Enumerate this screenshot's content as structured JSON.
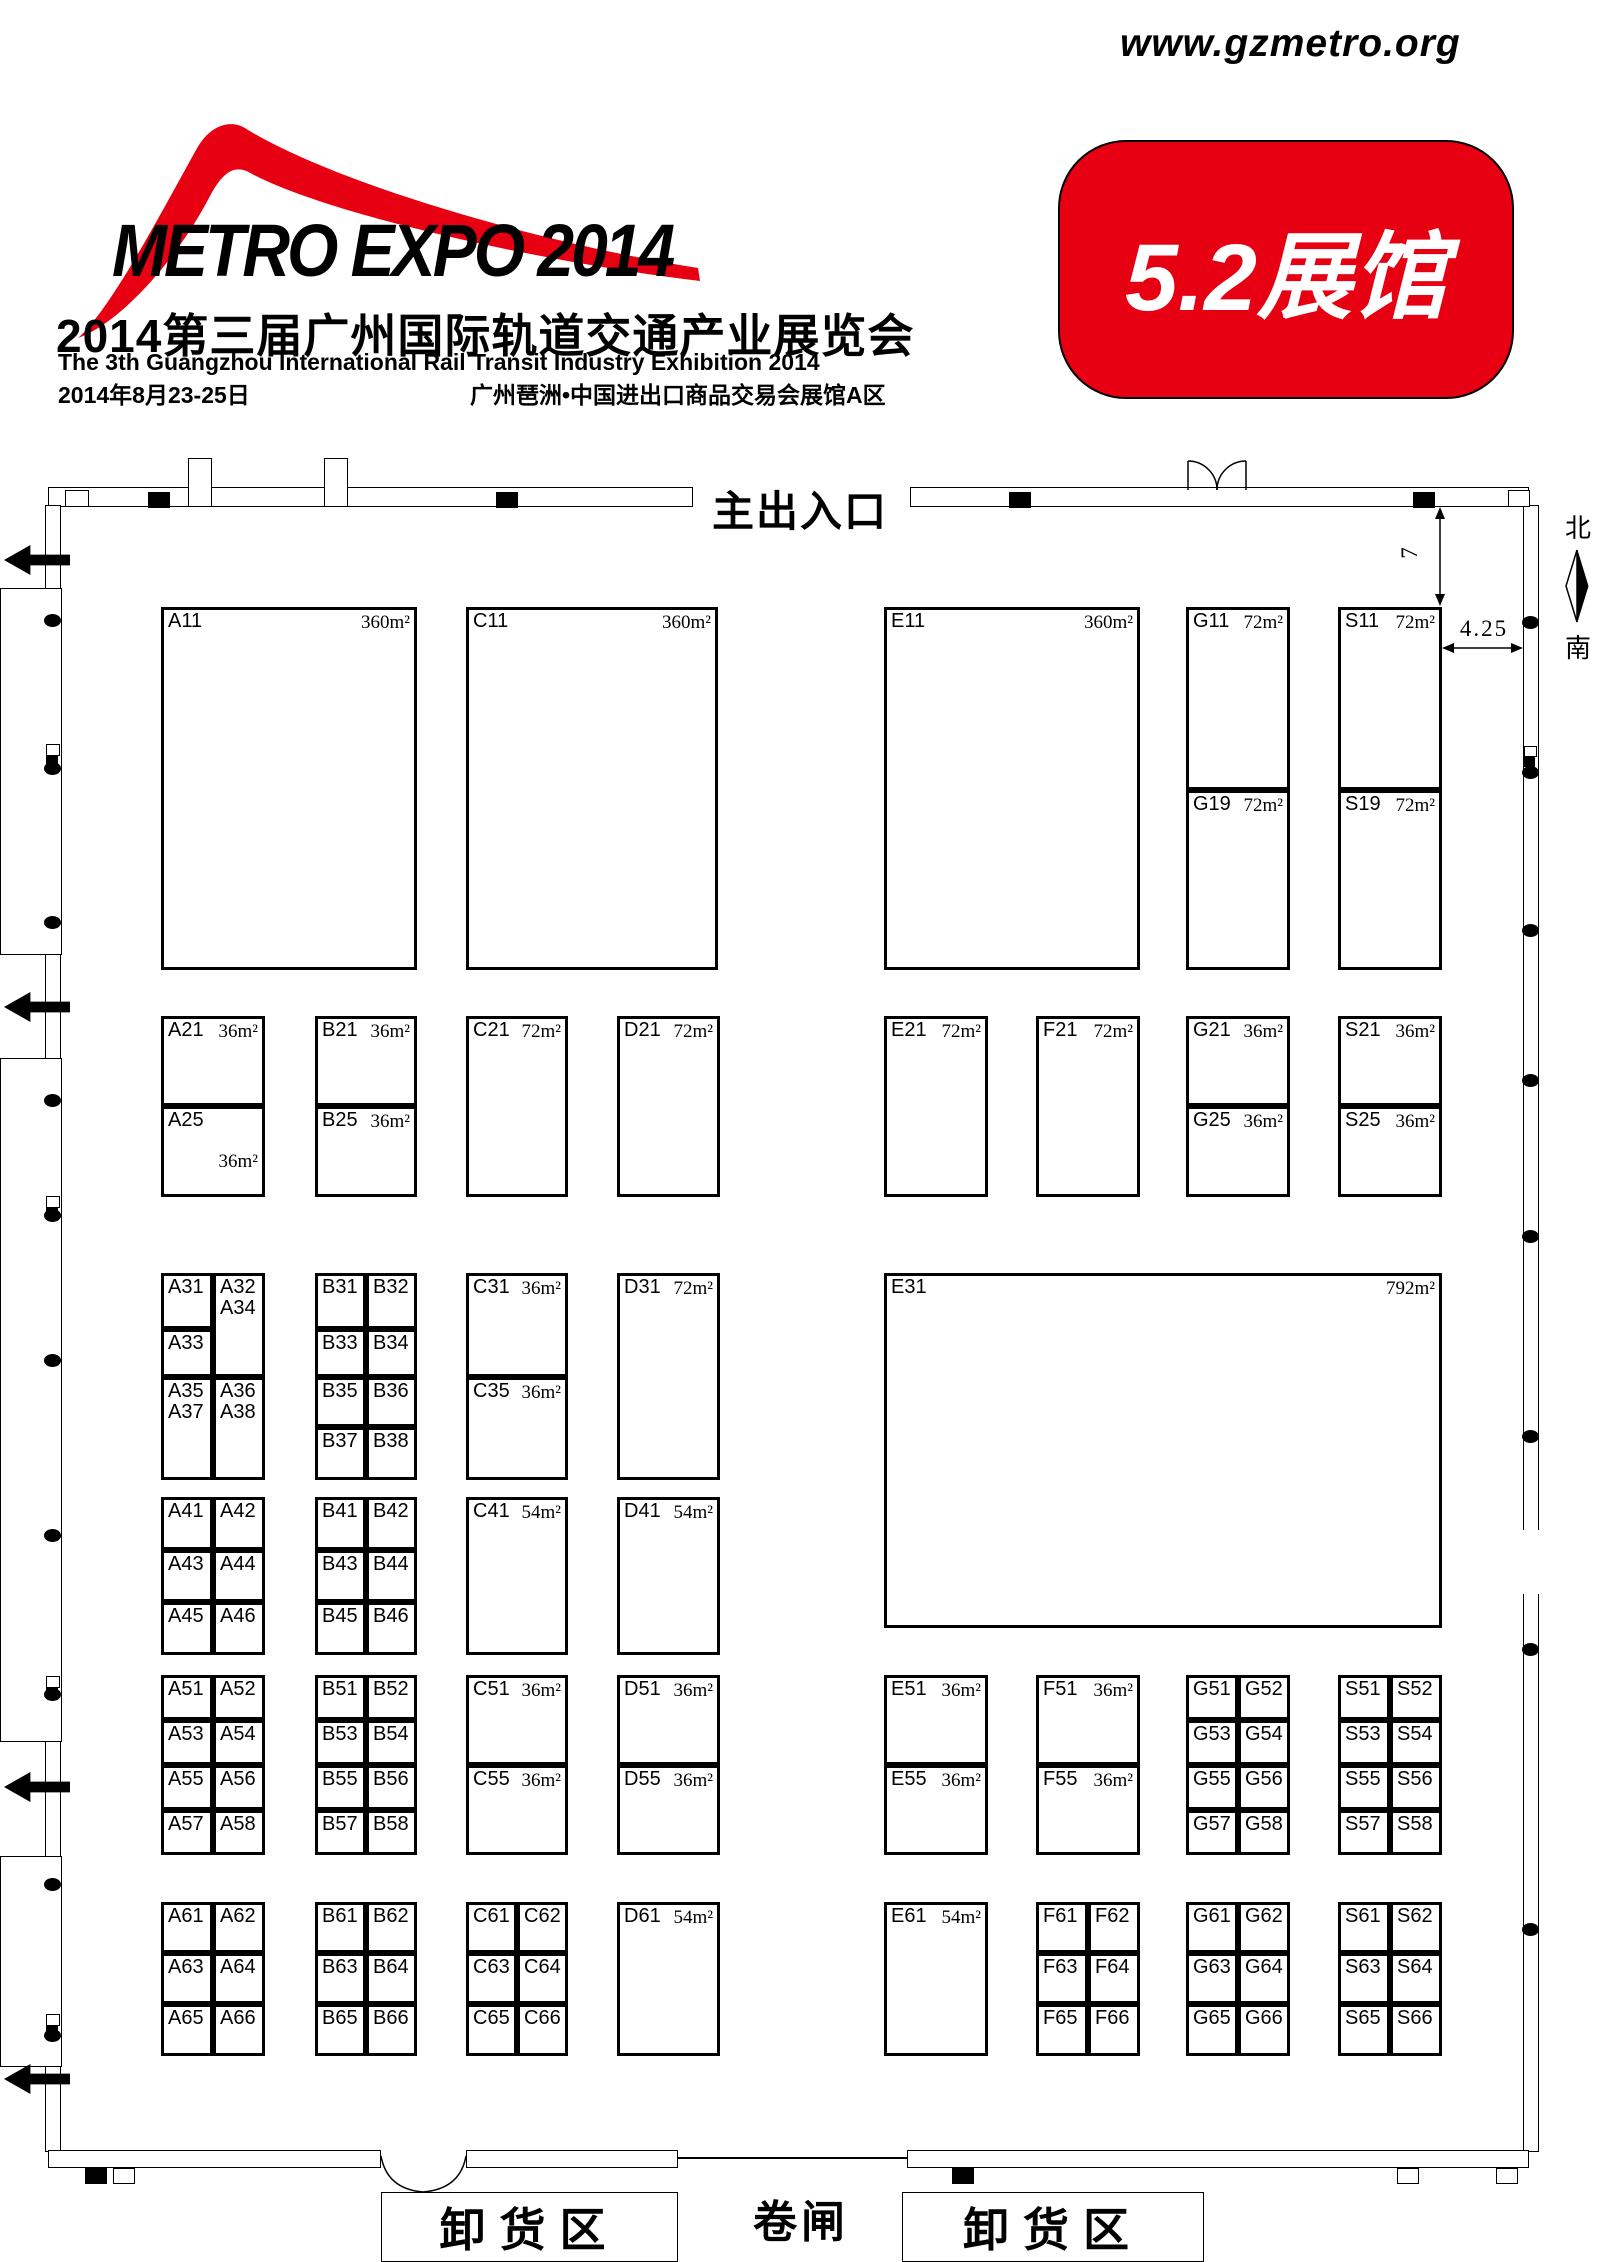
{
  "header": {
    "logo_text": "METRO EXPO 2014",
    "title_cn": "2014第三届广州国际轨道交通产业展览会",
    "title_en": "The 3th Guangzhou International Rail Transit Industry Exhibition 2014",
    "date": "2014年8月23-25日",
    "venue": "广州琶洲•中国进出口商品交易会展馆A区",
    "url": "www.gzmetro.org",
    "hall_badge": "5.2展馆",
    "accent_color": "#e60012"
  },
  "plan": {
    "entrance_label": "主出入口",
    "compass": {
      "north": "北",
      "south": "南"
    },
    "dim_vertical": "7",
    "dim_horizontal": "4.25",
    "unload_left_label": "卸货区",
    "gate_label": "卷闸",
    "unload_right_label": "卸货区",
    "booths": [
      [
        "A11",
        161,
        607,
        256,
        363,
        "360m²"
      ],
      [
        "C11",
        466,
        607,
        252,
        363,
        "360m²"
      ],
      [
        "E11",
        884,
        607,
        256,
        363,
        "360m²"
      ],
      [
        "G11",
        1186,
        607,
        104,
        183,
        "72m²"
      ],
      [
        "G19",
        1186,
        790,
        104,
        180,
        "72m²"
      ],
      [
        "S11",
        1338,
        607,
        104,
        183,
        "72m²"
      ],
      [
        "S19",
        1338,
        790,
        104,
        180,
        "72m²"
      ],
      [
        "A21",
        161,
        1016,
        104,
        90,
        "36m²"
      ],
      [
        "A25",
        161,
        1106,
        104,
        91,
        "36m²",
        "low"
      ],
      [
        "B21",
        315,
        1016,
        102,
        90,
        "36m²"
      ],
      [
        "B25",
        315,
        1106,
        102,
        91,
        "36m²"
      ],
      [
        "C21",
        466,
        1016,
        102,
        181,
        "72m²"
      ],
      [
        "D21",
        617,
        1016,
        103,
        181,
        "72m²"
      ],
      [
        "E21",
        884,
        1016,
        104,
        181,
        "72m²"
      ],
      [
        "F21",
        1036,
        1016,
        104,
        181,
        "72m²"
      ],
      [
        "G21",
        1186,
        1016,
        104,
        90,
        "36m²"
      ],
      [
        "G25",
        1186,
        1106,
        104,
        91,
        "36m²"
      ],
      [
        "S21",
        1338,
        1016,
        104,
        90,
        "36m²"
      ],
      [
        "S25",
        1338,
        1106,
        104,
        91,
        "36m²"
      ],
      [
        "A31",
        161,
        1273,
        52,
        56,
        ""
      ],
      [
        "A33",
        161,
        1329,
        52,
        48,
        ""
      ],
      [
        "A35\nA37",
        161,
        1377,
        52,
        103,
        ""
      ],
      [
        "A32\nA34",
        213,
        1273,
        52,
        104,
        ""
      ],
      [
        "A36\nA38",
        213,
        1377,
        52,
        103,
        ""
      ],
      [
        "B31",
        315,
        1273,
        51,
        56,
        ""
      ],
      [
        "B32",
        366,
        1273,
        51,
        56,
        ""
      ],
      [
        "B33",
        315,
        1329,
        51,
        48,
        ""
      ],
      [
        "B34",
        366,
        1329,
        51,
        48,
        ""
      ],
      [
        "B35",
        315,
        1377,
        51,
        50,
        ""
      ],
      [
        "B36",
        366,
        1377,
        51,
        50,
        ""
      ],
      [
        "B37",
        315,
        1427,
        51,
        53,
        ""
      ],
      [
        "B38",
        366,
        1427,
        51,
        53,
        ""
      ],
      [
        "C31",
        466,
        1273,
        102,
        104,
        "36m²"
      ],
      [
        "C35",
        466,
        1377,
        102,
        103,
        "36m²"
      ],
      [
        "D31",
        617,
        1273,
        103,
        207,
        "72m²"
      ],
      [
        "E31",
        884,
        1273,
        558,
        355,
        "792m²"
      ],
      [
        "A41",
        161,
        1497,
        52,
        53,
        ""
      ],
      [
        "A42",
        213,
        1497,
        52,
        53,
        ""
      ],
      [
        "A43",
        161,
        1550,
        52,
        52,
        ""
      ],
      [
        "A44",
        213,
        1550,
        52,
        52,
        ""
      ],
      [
        "A45",
        161,
        1602,
        52,
        53,
        ""
      ],
      [
        "A46",
        213,
        1602,
        52,
        53,
        ""
      ],
      [
        "B41",
        315,
        1497,
        51,
        53,
        ""
      ],
      [
        "B42",
        366,
        1497,
        51,
        53,
        ""
      ],
      [
        "B43",
        315,
        1550,
        51,
        52,
        ""
      ],
      [
        "B44",
        366,
        1550,
        51,
        52,
        ""
      ],
      [
        "B45",
        315,
        1602,
        51,
        53,
        ""
      ],
      [
        "B46",
        366,
        1602,
        51,
        53,
        ""
      ],
      [
        "C41",
        466,
        1497,
        102,
        158,
        "54m²"
      ],
      [
        "D41",
        617,
        1497,
        103,
        158,
        "54m²"
      ],
      [
        "A51",
        161,
        1675,
        52,
        45,
        ""
      ],
      [
        "A52",
        213,
        1675,
        52,
        45,
        ""
      ],
      [
        "A53",
        161,
        1720,
        52,
        45,
        ""
      ],
      [
        "A54",
        213,
        1720,
        52,
        45,
        ""
      ],
      [
        "A55",
        161,
        1765,
        52,
        45,
        ""
      ],
      [
        "A56",
        213,
        1765,
        52,
        45,
        ""
      ],
      [
        "A57",
        161,
        1810,
        52,
        45,
        ""
      ],
      [
        "A58",
        213,
        1810,
        52,
        45,
        ""
      ],
      [
        "B51",
        315,
        1675,
        51,
        45,
        ""
      ],
      [
        "B52",
        366,
        1675,
        51,
        45,
        ""
      ],
      [
        "B53",
        315,
        1720,
        51,
        45,
        ""
      ],
      [
        "B54",
        366,
        1720,
        51,
        45,
        ""
      ],
      [
        "B55",
        315,
        1765,
        51,
        45,
        ""
      ],
      [
        "B56",
        366,
        1765,
        51,
        45,
        ""
      ],
      [
        "B57",
        315,
        1810,
        51,
        45,
        ""
      ],
      [
        "B58",
        366,
        1810,
        51,
        45,
        ""
      ],
      [
        "C51",
        466,
        1675,
        102,
        90,
        "36m²"
      ],
      [
        "C55",
        466,
        1765,
        102,
        90,
        "36m²"
      ],
      [
        "D51",
        617,
        1675,
        103,
        90,
        "36m²"
      ],
      [
        "D55",
        617,
        1765,
        103,
        90,
        "36m²"
      ],
      [
        "E51",
        884,
        1675,
        104,
        90,
        "36m²"
      ],
      [
        "E55",
        884,
        1765,
        104,
        90,
        "36m²"
      ],
      [
        "F51",
        1036,
        1675,
        104,
        90,
        "36m²"
      ],
      [
        "F55",
        1036,
        1765,
        104,
        90,
        "36m²"
      ],
      [
        "G51",
        1186,
        1675,
        52,
        45,
        ""
      ],
      [
        "G52",
        1238,
        1675,
        52,
        45,
        ""
      ],
      [
        "G53",
        1186,
        1720,
        52,
        45,
        ""
      ],
      [
        "G54",
        1238,
        1720,
        52,
        45,
        ""
      ],
      [
        "G55",
        1186,
        1765,
        52,
        45,
        ""
      ],
      [
        "G56",
        1238,
        1765,
        52,
        45,
        ""
      ],
      [
        "G57",
        1186,
        1810,
        52,
        45,
        ""
      ],
      [
        "G58",
        1238,
        1810,
        52,
        45,
        ""
      ],
      [
        "S51",
        1338,
        1675,
        52,
        45,
        ""
      ],
      [
        "S52",
        1390,
        1675,
        52,
        45,
        ""
      ],
      [
        "S53",
        1338,
        1720,
        52,
        45,
        ""
      ],
      [
        "S54",
        1390,
        1720,
        52,
        45,
        ""
      ],
      [
        "S55",
        1338,
        1765,
        52,
        45,
        ""
      ],
      [
        "S56",
        1390,
        1765,
        52,
        45,
        ""
      ],
      [
        "S57",
        1338,
        1810,
        52,
        45,
        ""
      ],
      [
        "S58",
        1390,
        1810,
        52,
        45,
        ""
      ],
      [
        "A61",
        161,
        1902,
        52,
        51,
        ""
      ],
      [
        "A62",
        213,
        1902,
        52,
        51,
        ""
      ],
      [
        "A63",
        161,
        1953,
        52,
        51,
        ""
      ],
      [
        "A64",
        213,
        1953,
        52,
        51,
        ""
      ],
      [
        "A65",
        161,
        2004,
        52,
        52,
        ""
      ],
      [
        "A66",
        213,
        2004,
        52,
        52,
        ""
      ],
      [
        "B61",
        315,
        1902,
        51,
        51,
        ""
      ],
      [
        "B62",
        366,
        1902,
        51,
        51,
        ""
      ],
      [
        "B63",
        315,
        1953,
        51,
        51,
        ""
      ],
      [
        "B64",
        366,
        1953,
        51,
        51,
        ""
      ],
      [
        "B65",
        315,
        2004,
        51,
        52,
        ""
      ],
      [
        "B66",
        366,
        2004,
        51,
        52,
        ""
      ],
      [
        "C61",
        466,
        1902,
        51,
        51,
        ""
      ],
      [
        "C62",
        517,
        1902,
        51,
        51,
        ""
      ],
      [
        "C63",
        466,
        1953,
        51,
        51,
        ""
      ],
      [
        "C64",
        517,
        1953,
        51,
        51,
        ""
      ],
      [
        "C65",
        466,
        2004,
        51,
        52,
        ""
      ],
      [
        "C66",
        517,
        2004,
        51,
        52,
        ""
      ],
      [
        "D61",
        617,
        1902,
        103,
        154,
        "54m²"
      ],
      [
        "E61",
        884,
        1902,
        104,
        154,
        "54m²"
      ],
      [
        "F61",
        1036,
        1902,
        52,
        51,
        ""
      ],
      [
        "F62",
        1088,
        1902,
        52,
        51,
        ""
      ],
      [
        "F63",
        1036,
        1953,
        52,
        51,
        ""
      ],
      [
        "F64",
        1088,
        1953,
        52,
        51,
        ""
      ],
      [
        "F65",
        1036,
        2004,
        52,
        52,
        ""
      ],
      [
        "F66",
        1088,
        2004,
        52,
        52,
        ""
      ],
      [
        "G61",
        1186,
        1902,
        52,
        51,
        ""
      ],
      [
        "G62",
        1238,
        1902,
        52,
        51,
        ""
      ],
      [
        "G63",
        1186,
        1953,
        52,
        51,
        ""
      ],
      [
        "G64",
        1238,
        1953,
        52,
        51,
        ""
      ],
      [
        "G65",
        1186,
        2004,
        52,
        52,
        ""
      ],
      [
        "G66",
        1238,
        2004,
        52,
        52,
        ""
      ],
      [
        "S61",
        1338,
        1902,
        52,
        51,
        ""
      ],
      [
        "S62",
        1390,
        1902,
        52,
        51,
        ""
      ],
      [
        "S63",
        1338,
        1953,
        52,
        51,
        ""
      ],
      [
        "S64",
        1390,
        1953,
        52,
        51,
        ""
      ],
      [
        "S65",
        1338,
        2004,
        52,
        52,
        ""
      ],
      [
        "S66",
        1390,
        2004,
        52,
        52,
        ""
      ]
    ],
    "decor": {
      "left_arrows": [
        560,
        1007,
        1787,
        2079
      ],
      "left_dots": [
        620,
        768,
        922,
        1100,
        1215,
        1360,
        1535,
        1694,
        1884,
        2035
      ],
      "left_marks": [
        744,
        1196,
        1676,
        2014
      ],
      "right_dots": [
        622,
        772,
        930,
        1080,
        1236,
        1436,
        1649,
        1929
      ],
      "right_marks": [
        746
      ],
      "top_black": [
        148,
        496,
        1009,
        1413
      ],
      "top_tabs": [
        [
          65,
          490,
          24,
          17
        ],
        [
          188,
          458,
          24,
          49
        ],
        [
          324,
          458,
          24,
          49
        ],
        [
          1508,
          490,
          22,
          17
        ]
      ],
      "bottom_black": [
        85,
        952
      ],
      "bottom_tabs": [
        113,
        1397,
        1496
      ]
    }
  }
}
